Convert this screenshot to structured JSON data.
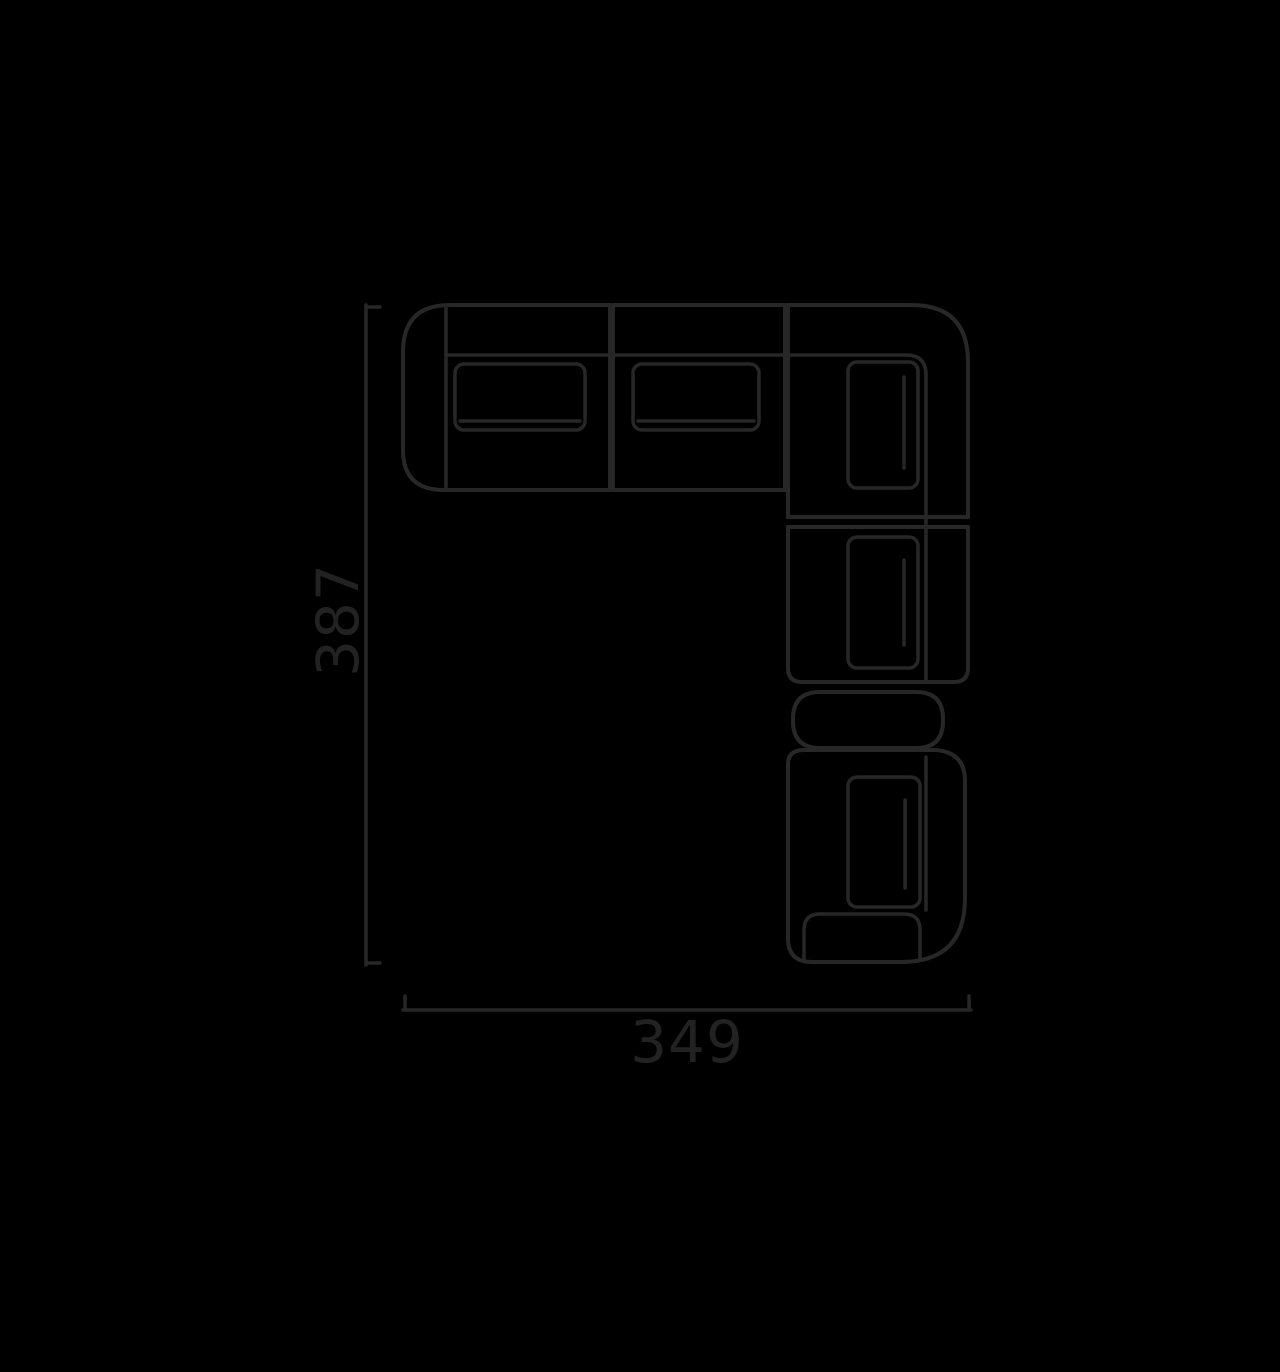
{
  "diagram": {
    "kind": "sectional-sofa-top-view-floor-plan",
    "colors": {
      "background": "#000000",
      "line": "#272727",
      "label": "#222222"
    },
    "height_dimension": {
      "label": "387",
      "orientation": "vertical"
    },
    "width_dimension": {
      "label": "349",
      "orientation": "horizontal"
    }
  }
}
